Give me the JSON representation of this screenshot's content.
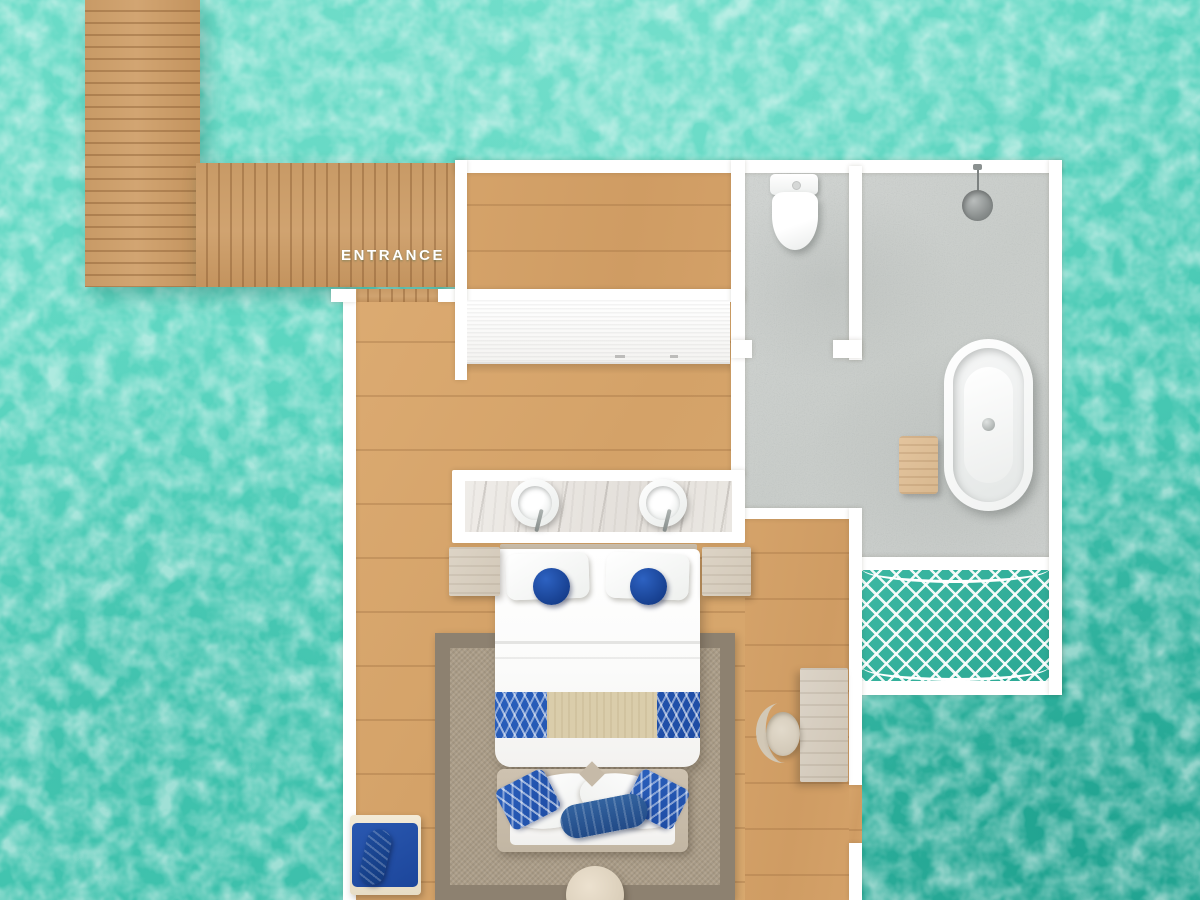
{
  "meta": {
    "view": "overwater-villa-floor-plan"
  },
  "labels": {
    "entrance": "ENTRANCE"
  },
  "palette": {
    "water": "#5bd5c0",
    "water_deep": "#2fae9b",
    "deck_wood": "#c89a66",
    "interior_wood": "#d9a96f",
    "wall_white": "#ffffff",
    "bathroom_concrete": "#ced1cf",
    "marble_counter": "#eae7e2",
    "rug_field": "#ab9d88",
    "rug_border": "#8d8170",
    "accent_royal_blue": "#1d4ea6",
    "linen_white": "#ffffff",
    "frame_tan": "#c9bdab",
    "net_teal": "#35b09e"
  },
  "fixtures": [
    "entrance-deck-walkway",
    "entrance-door-opening",
    "walk-in-closet-floor",
    "wardrobe-dresser",
    "toilet",
    "shower-head",
    "freestanding-bathtub",
    "bath-stool",
    "double-vanity-marble-counter",
    "sink-left",
    "sink-right",
    "king-bed",
    "pillows",
    "round-blue-cushions",
    "chevron-bed-runner",
    "nightstand-left",
    "nightstand-right",
    "area-rug",
    "curved-sofa",
    "blue-throw-pillows",
    "bolster-cushion",
    "round-coffee-table",
    "writing-desk",
    "desk-chair",
    "lounge-daybed",
    "rolled-towel",
    "overwater-hammock-net"
  ]
}
